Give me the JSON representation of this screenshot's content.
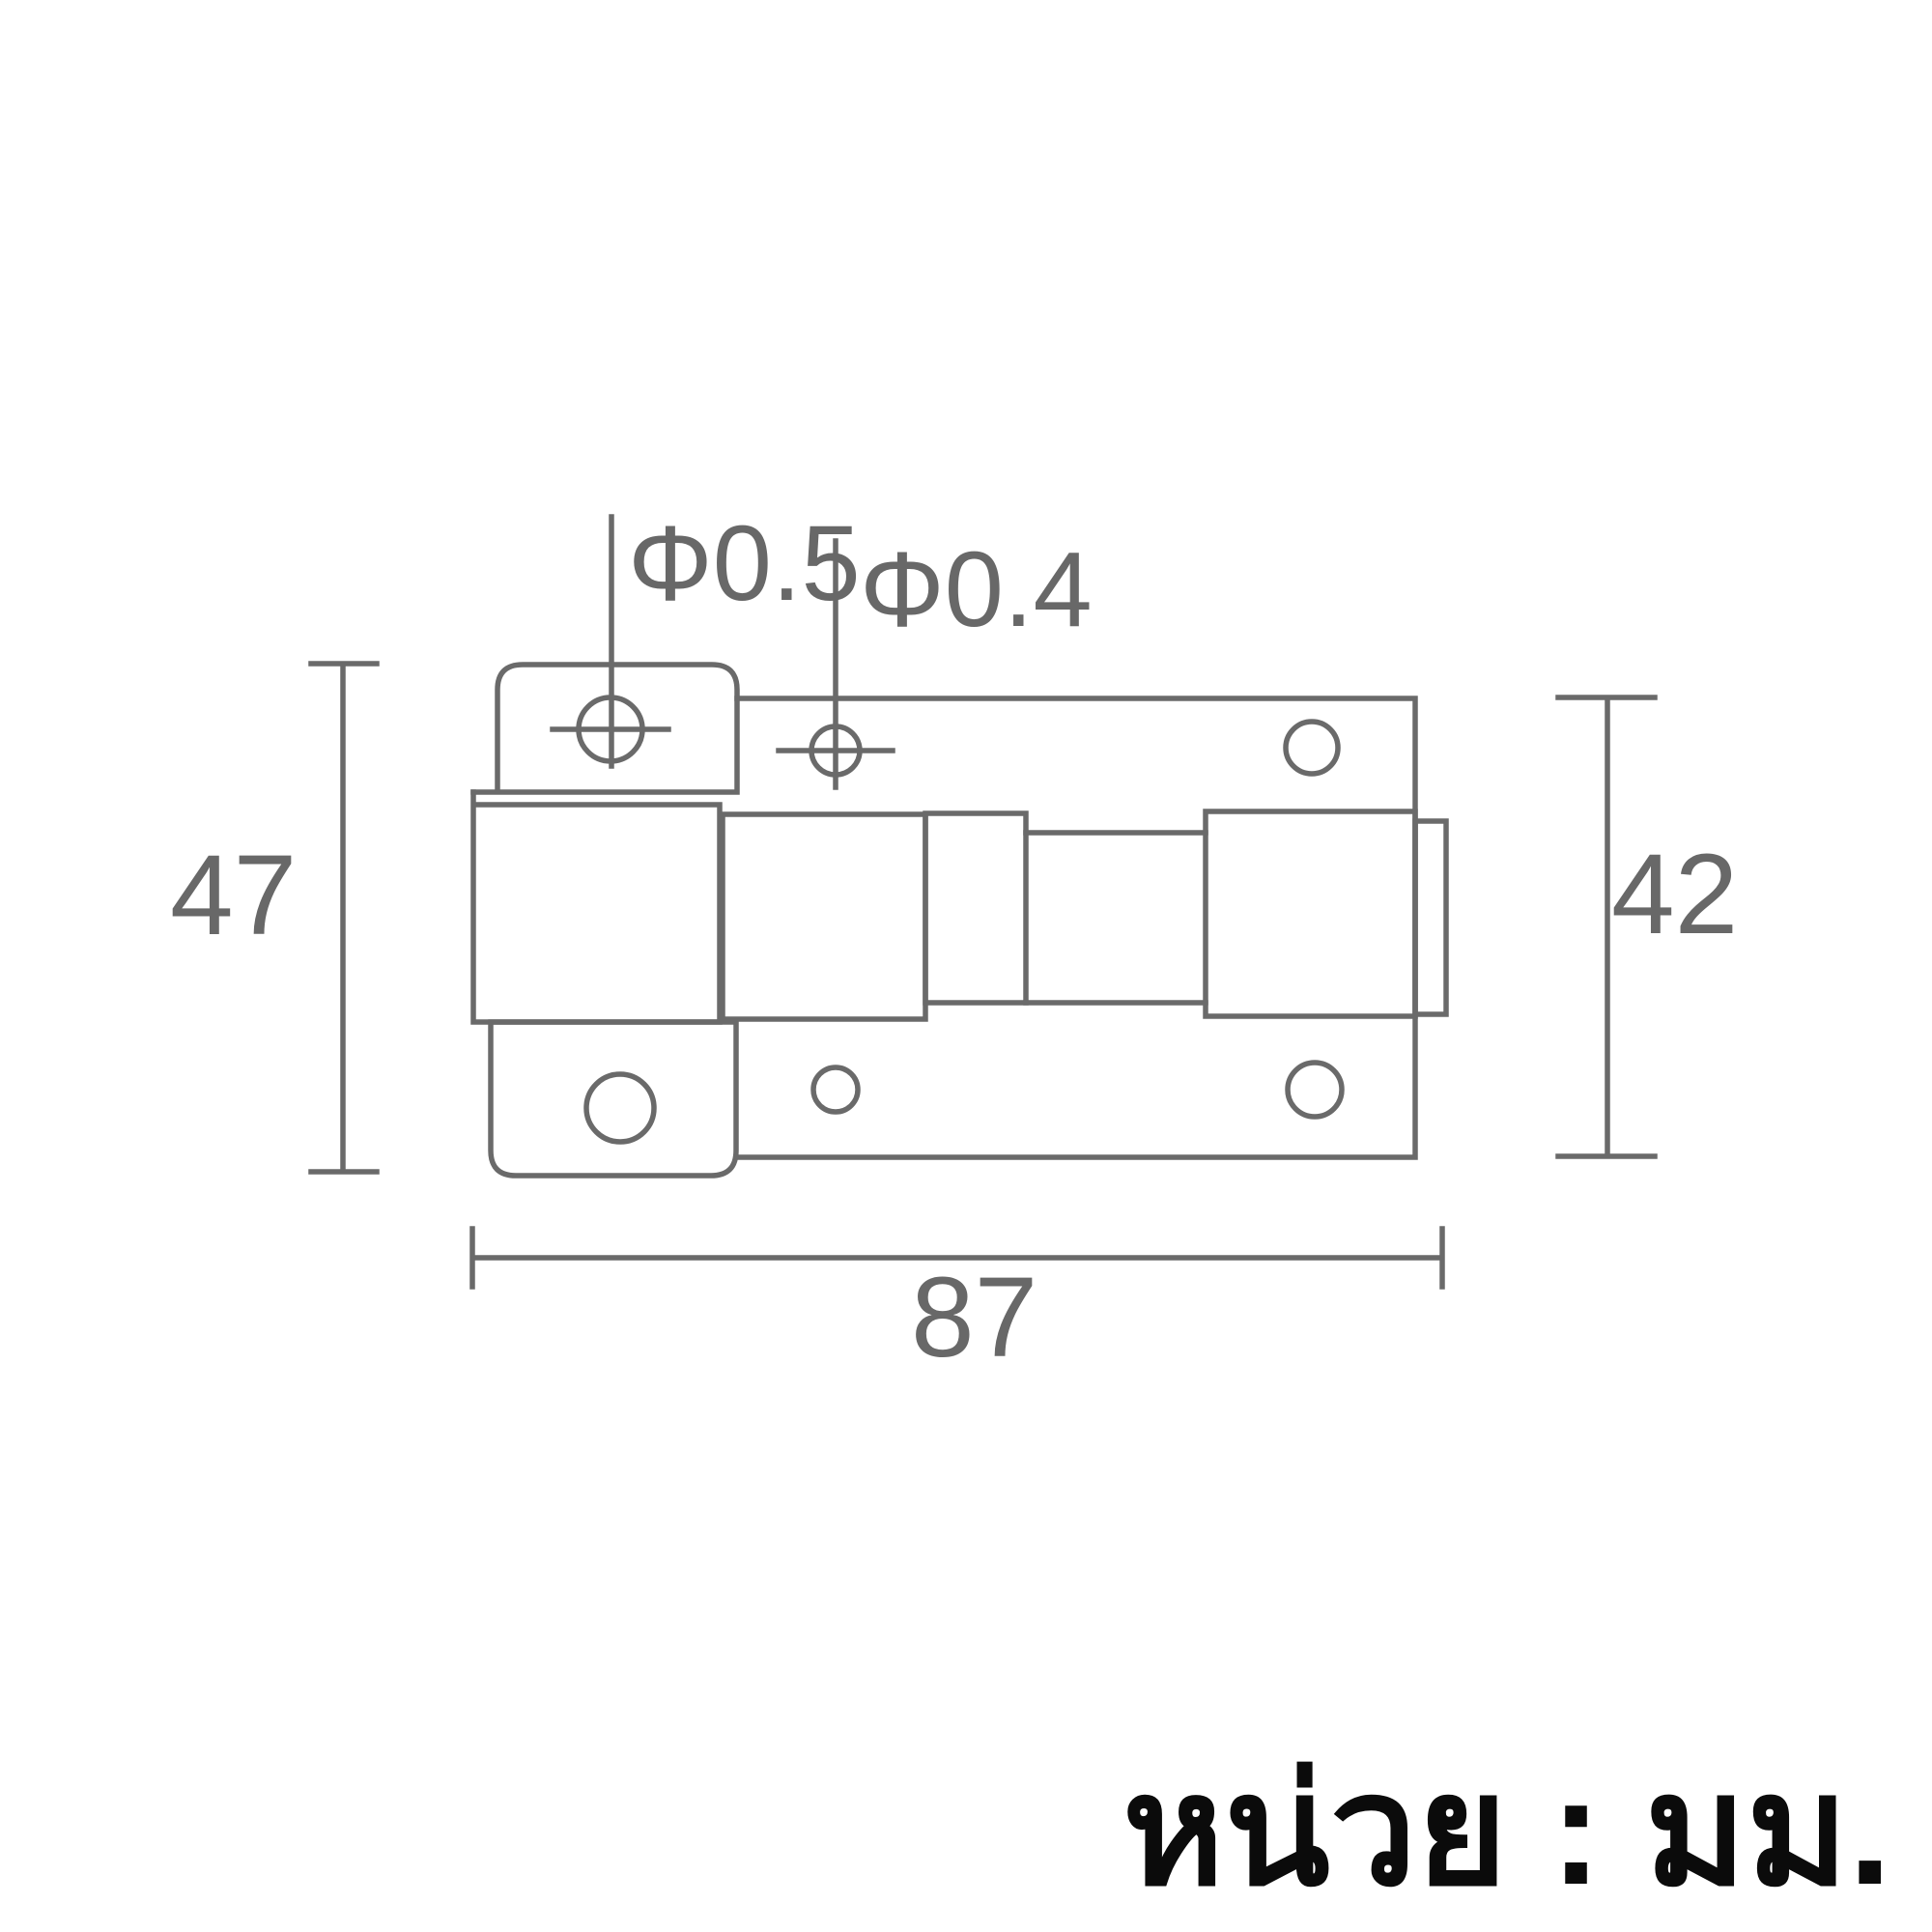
{
  "drawing": {
    "dim_labels": {
      "hole_large": "Φ0.5",
      "hole_small": "Φ0.4",
      "left_height": "47",
      "right_height": "42",
      "overall_width": "87"
    },
    "unit_note": "หน่วย : มม.",
    "colors": {
      "line": "#6a6a6a",
      "dim_text": "#686868",
      "note_text": "#0b0b0b",
      "background": "#ffffff"
    }
  }
}
